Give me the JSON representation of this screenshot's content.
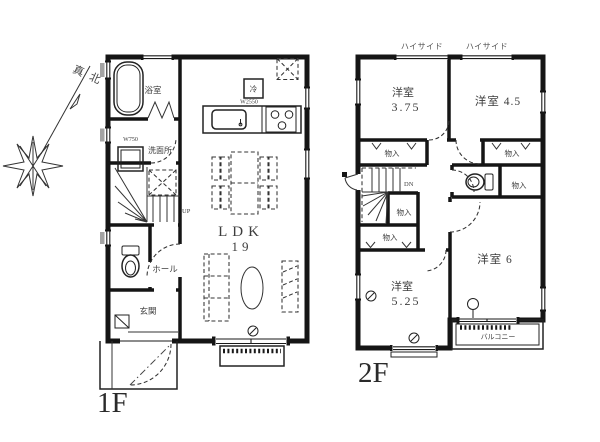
{
  "compass": {
    "north_label": "真北"
  },
  "floor1": {
    "floor_label": "1F",
    "bath_label": "浴室",
    "washroom_label": "洗面所",
    "washer_width_label": "W750",
    "counter_width_label": "W2550",
    "fridge_label": "冷",
    "hall_label": "ホール",
    "entrance_label": "玄関",
    "ldk_label": "LDK",
    "ldk_size_label": "19",
    "up_label": "UP"
  },
  "floor2": {
    "floor_label": "2F",
    "highside_labels": [
      "ハイサイド",
      "ハイサイド"
    ],
    "room_375": {
      "name": "洋室",
      "size": "3.75"
    },
    "room_45_label": "洋室 4.5",
    "room_6_label": "洋室 6",
    "room_525": {
      "name": "洋室",
      "size": "5.25"
    },
    "closet_labels": [
      "物入",
      "物入",
      "物入",
      "物入",
      "物入"
    ],
    "balcony_label": "バルコニー",
    "down_label": "DN"
  }
}
